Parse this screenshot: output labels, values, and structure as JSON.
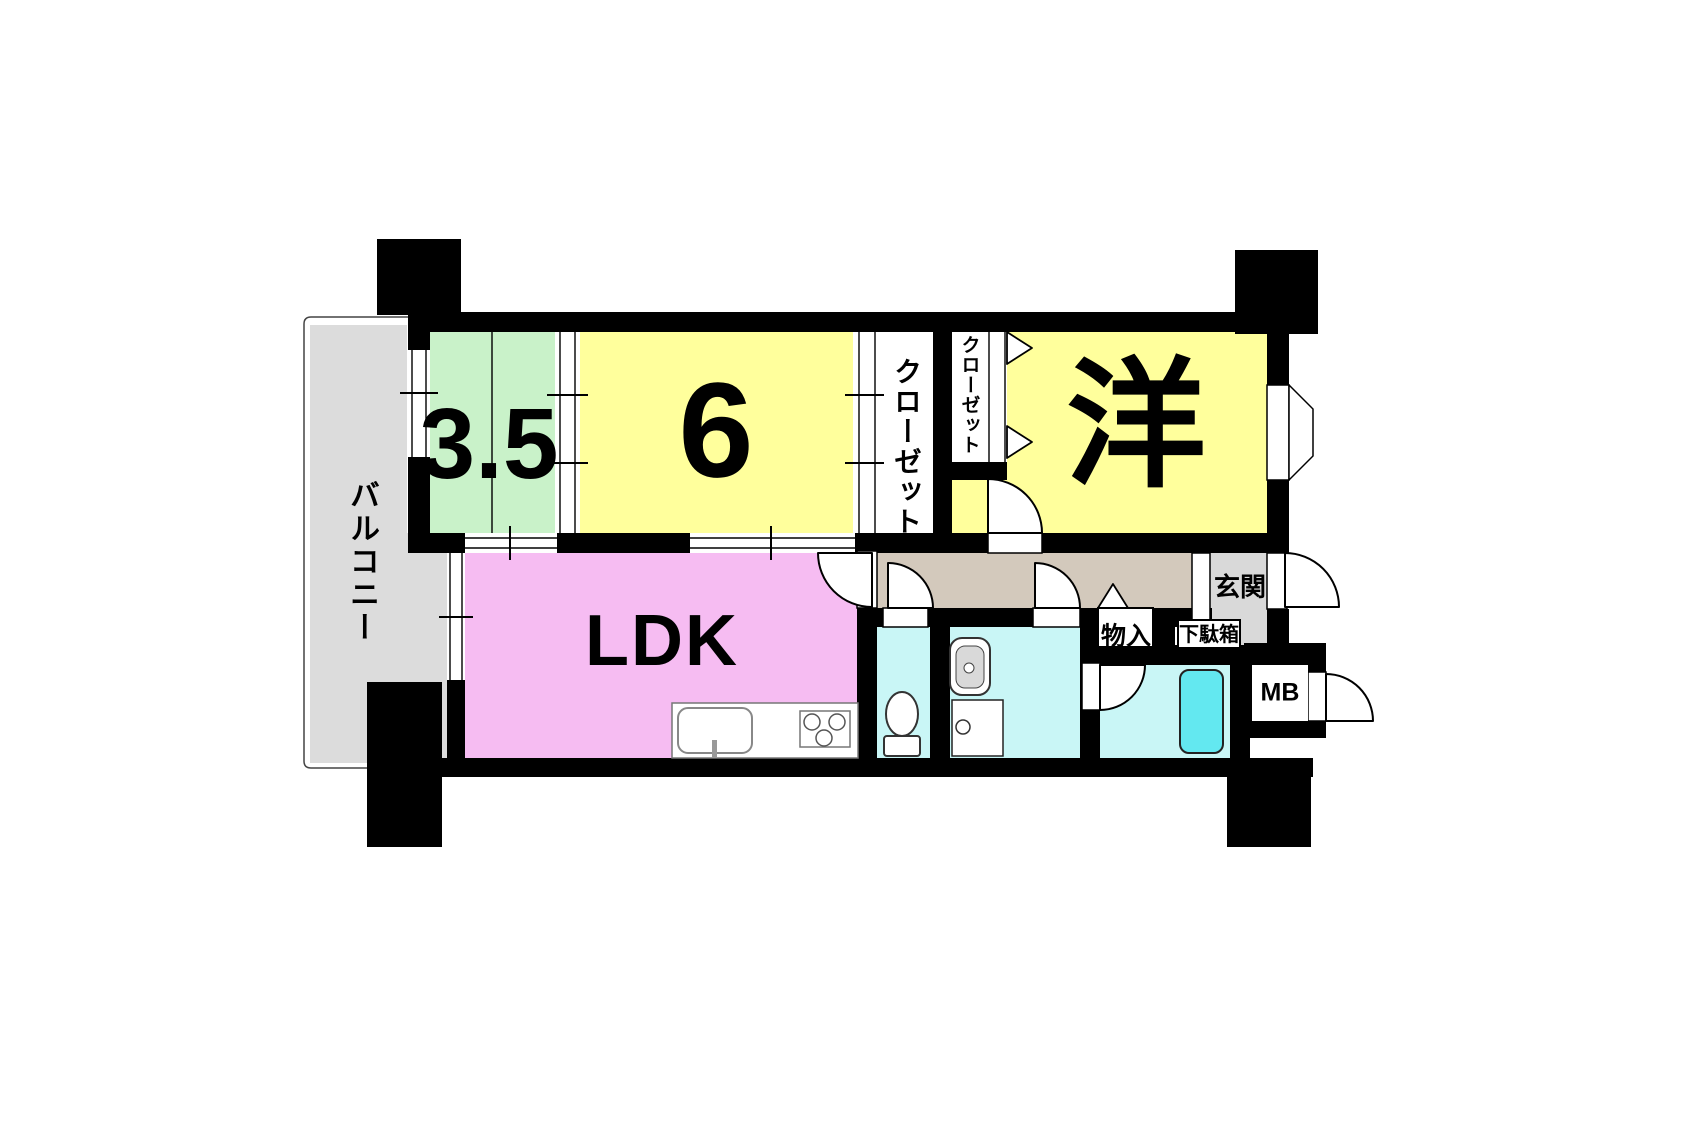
{
  "labels": {
    "balcony": "バルコニー",
    "room_3_5": "3.5",
    "room_6": "6",
    "closet_1": "クローゼット",
    "closet_2": "クローゼット",
    "western_room": "洋",
    "ldk": "LDK",
    "entrance": "玄関",
    "storage": "物入",
    "shoe_cabinet": "下駄箱",
    "meter_box": "MB"
  },
  "colors": {
    "wall": "#000000",
    "balcony_floor": "#dcdcdc",
    "entrance_floor": "#d9d9d9",
    "room_green": "#c9f2c9",
    "room_yellow": "#ffff9c",
    "room_pink": "#f6bcf2",
    "wet_area_cyan": "#c9f6f6",
    "bathtub_cyan": "#63e8f0",
    "hallway_tan": "#d3c9bc"
  }
}
